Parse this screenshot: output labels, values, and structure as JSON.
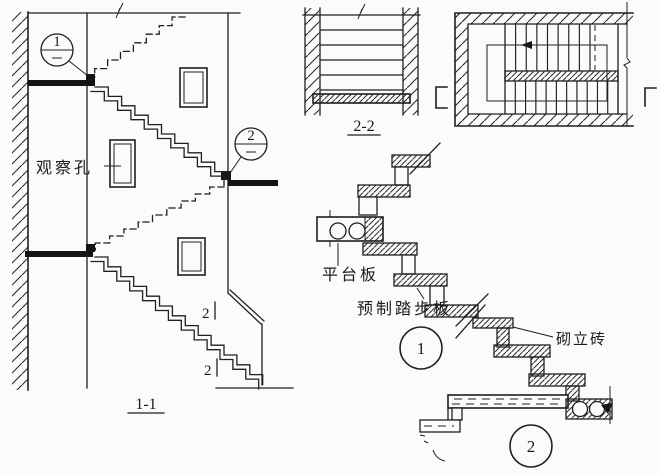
{
  "colors": {
    "ink": "#1f1f1f",
    "paper": "#fbfbf9"
  },
  "section_1_1": {
    "label": "1-1",
    "observation_hole_label": "观察孔",
    "callout_1_number": "1",
    "callout_2_number": "2",
    "cut_mark_upper": "2",
    "cut_mark_lower": "2"
  },
  "section_2_2": {
    "label": "2-2"
  },
  "detail_1": {
    "number": "1",
    "platform_slab_label": "平台板",
    "precast_tread_label": "预制踏步板"
  },
  "detail_2": {
    "number": "2",
    "upright_brick_label": "砌立砖"
  }
}
